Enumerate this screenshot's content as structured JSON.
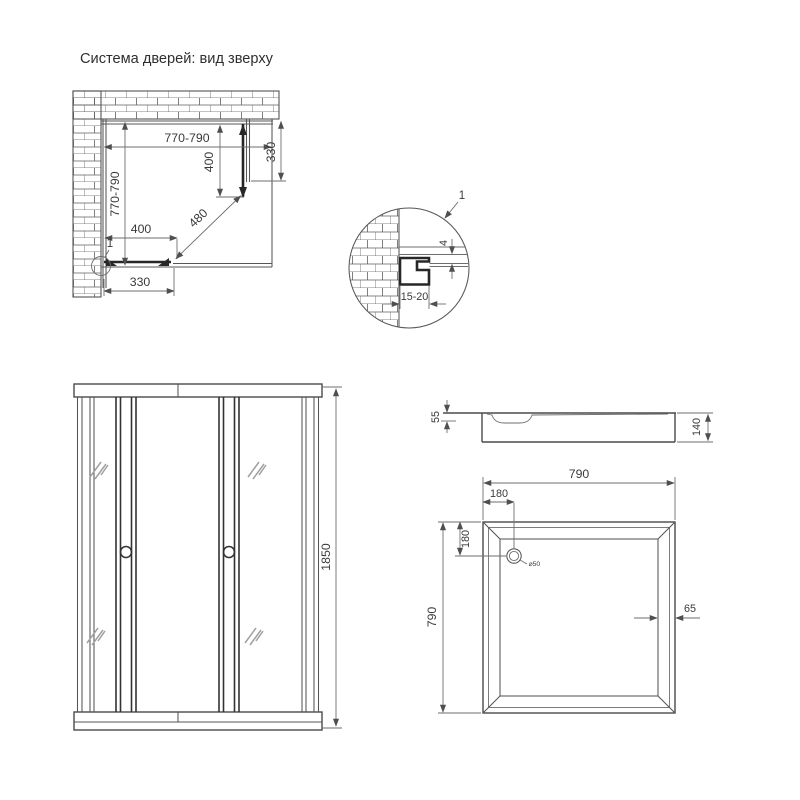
{
  "title": "Система дверей: вид зверху",
  "colors": {
    "ink": "#4a4a4a",
    "text": "#3a3a3a",
    "profile_dark": "#272727"
  },
  "plan_view": {
    "width_dim": "770-790",
    "depth_dim": "770-790",
    "right_door_dim": "400",
    "right_panel_dim": "330",
    "bottom_door_dim": "400",
    "bottom_panel_dim": "330",
    "diagonal_dim": "480",
    "detail_callout": "1"
  },
  "detail_view": {
    "callout": "1",
    "gap_dim": "4",
    "profile_range_dim": "15-20"
  },
  "front_view": {
    "height_dim": "1850"
  },
  "tray_side_view": {
    "basin_depth_dim": "55",
    "total_height_dim": "140"
  },
  "tray_top_view": {
    "width_dim": "790",
    "depth_dim": "790",
    "drain_offset_x_dim": "180",
    "drain_offset_y_dim": "180",
    "drain_label": "⌀50",
    "rim_dim": "65"
  }
}
